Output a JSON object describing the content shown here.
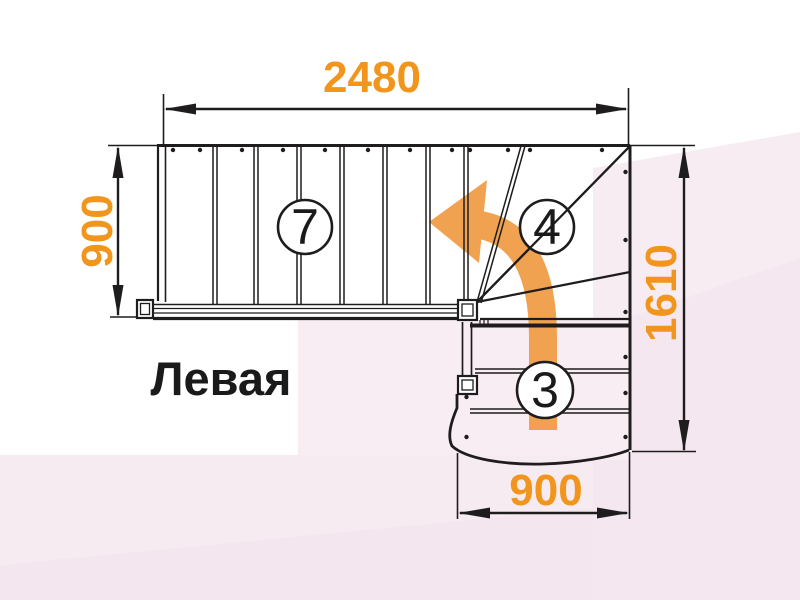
{
  "diagram": {
    "type": "staircase-plan",
    "orientation_label": "Левая",
    "dimensions_mm": {
      "top_width": "2480",
      "left_depth": "900",
      "right_height": "1610",
      "bottom_width": "900"
    },
    "step_counts": {
      "upper_flight": "7",
      "winder_turn": "4",
      "lower_flight": "3"
    },
    "arrow_direction": "up-then-left-turn",
    "colors": {
      "dimension_text": "#F2951C",
      "direction_arrow": "#F0A250",
      "drawing_lines": "#1E1C1C",
      "background_tint": "#F8ECF3"
    }
  }
}
